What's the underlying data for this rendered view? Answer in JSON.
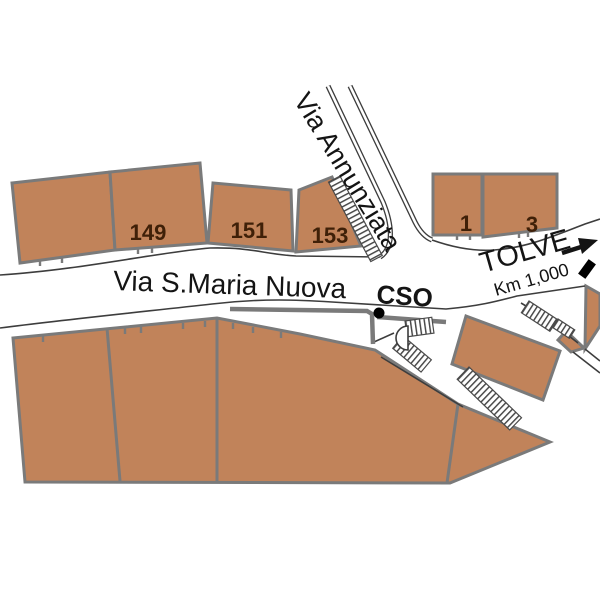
{
  "streets": {
    "annunziata": "Via Annunziata",
    "santa_maria_nuova": "Via S.Maria Nuova",
    "cso": "CSO"
  },
  "direction": {
    "destination": "TOLVE",
    "distance": "Km 1,000"
  },
  "parcels": {
    "p149": "149",
    "p151": "151",
    "p153": "153",
    "p1": "1",
    "p3": "3"
  },
  "colors": {
    "building-fill": "#c1835a",
    "building-stroke": "#7a7a7a",
    "road-line": "#3d3d3d",
    "label": "#141414",
    "number": "#3f2008",
    "marker": "#000000"
  }
}
